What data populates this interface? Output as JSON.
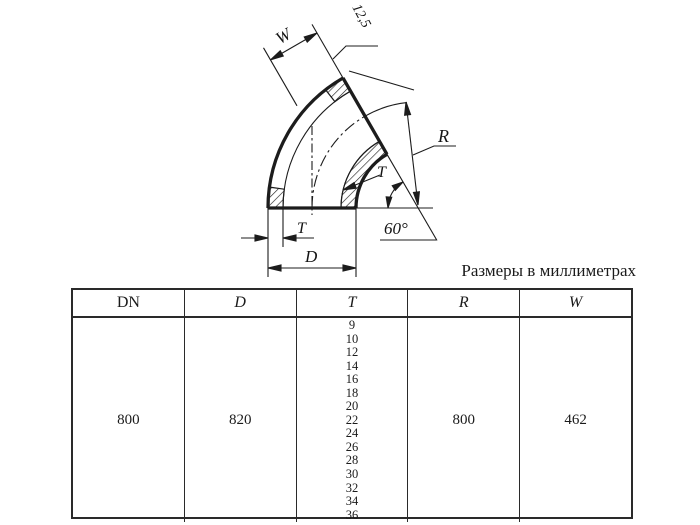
{
  "drawing": {
    "labels": {
      "width": "W",
      "roughness": "12,5",
      "radius": "R",
      "wall_section": "T",
      "angle": "60°",
      "wall_thickness": "T",
      "outer_diameter": "D"
    }
  },
  "caption": "Размеры в миллиметрах",
  "table": {
    "headers": [
      "DN",
      "D",
      "T",
      "R",
      "W"
    ],
    "row": {
      "dn": "800",
      "d": "820",
      "t_values": [
        "9",
        "10",
        "12",
        "14",
        "16",
        "18",
        "20",
        "22",
        "24",
        "26",
        "28",
        "30",
        "32",
        "34",
        "36"
      ],
      "r": "800",
      "w": "462"
    }
  }
}
